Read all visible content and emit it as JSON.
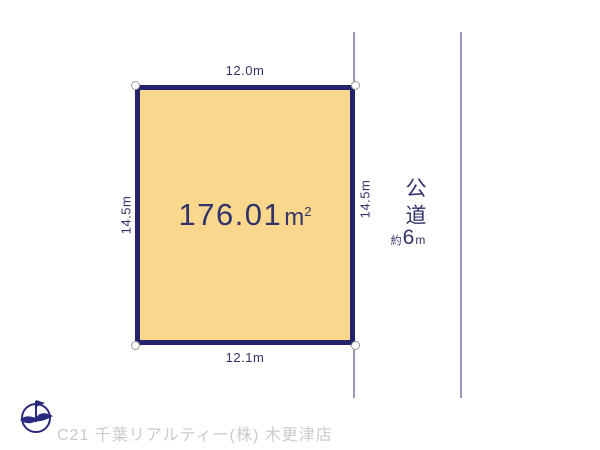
{
  "diagram": {
    "plot": {
      "area_value": "176.01",
      "area_unit_base": "m",
      "area_unit_sup": "2",
      "dim_top": "12.0m",
      "dim_bottom": "12.1m",
      "dim_left": "14.5m",
      "dim_right": "14.5m"
    },
    "road": {
      "name": "公道",
      "width_prefix": "約",
      "width_value": "6",
      "width_unit": "m"
    },
    "icons": {
      "compass": "north-arrow-compass-icon"
    },
    "footer": {
      "company": "C21 千葉リアルティー(株) 木更津店"
    },
    "colors": {
      "background": "#FFFFFF",
      "plot_fill": "#F9D78C",
      "plot_border": "#23236B",
      "text_navy": "#33336B",
      "road_line": "#9598BB",
      "footer_text": "#CBCBCB"
    }
  }
}
